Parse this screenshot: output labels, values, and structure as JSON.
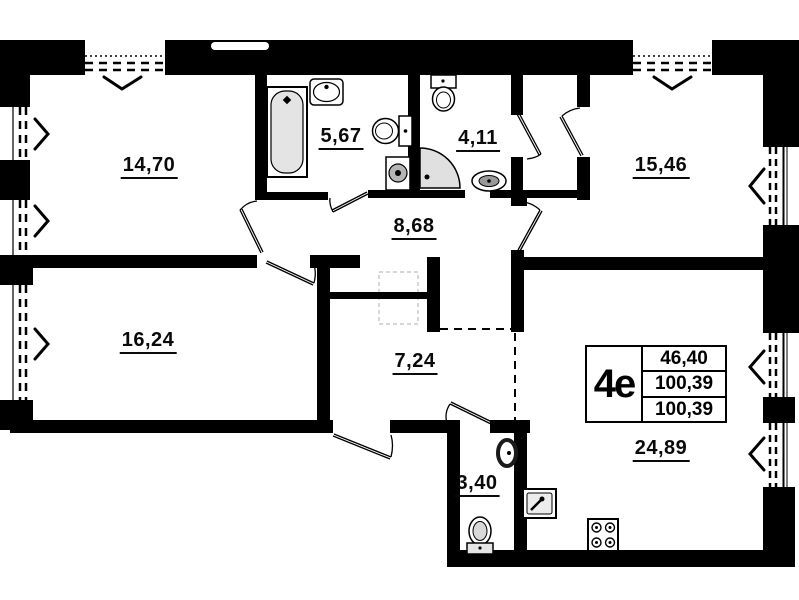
{
  "title": "apartment-floor-plan",
  "plan": {
    "apartment_type": "4е",
    "stamp": {
      "type_label": "4е",
      "row1": "46,40",
      "row2": "100,39",
      "row3": "100,39"
    },
    "rooms": [
      {
        "key": "bedroom-top-left",
        "area": "14,70"
      },
      {
        "key": "bathroom",
        "area": "5,67"
      },
      {
        "key": "wc-top",
        "area": "4,11"
      },
      {
        "key": "bedroom-top-right",
        "area": "15,46"
      },
      {
        "key": "hallway",
        "area": "8,68"
      },
      {
        "key": "bedroom-left",
        "area": "16,24"
      },
      {
        "key": "corridor",
        "area": "7,24"
      },
      {
        "key": "wc-bottom",
        "area": "3,40"
      },
      {
        "key": "kitchen-living",
        "area": "24,89"
      }
    ],
    "colors": {
      "wall": "#000000",
      "fixture_fill": "#e0e0e0",
      "faint": "#bdbdbd"
    }
  }
}
